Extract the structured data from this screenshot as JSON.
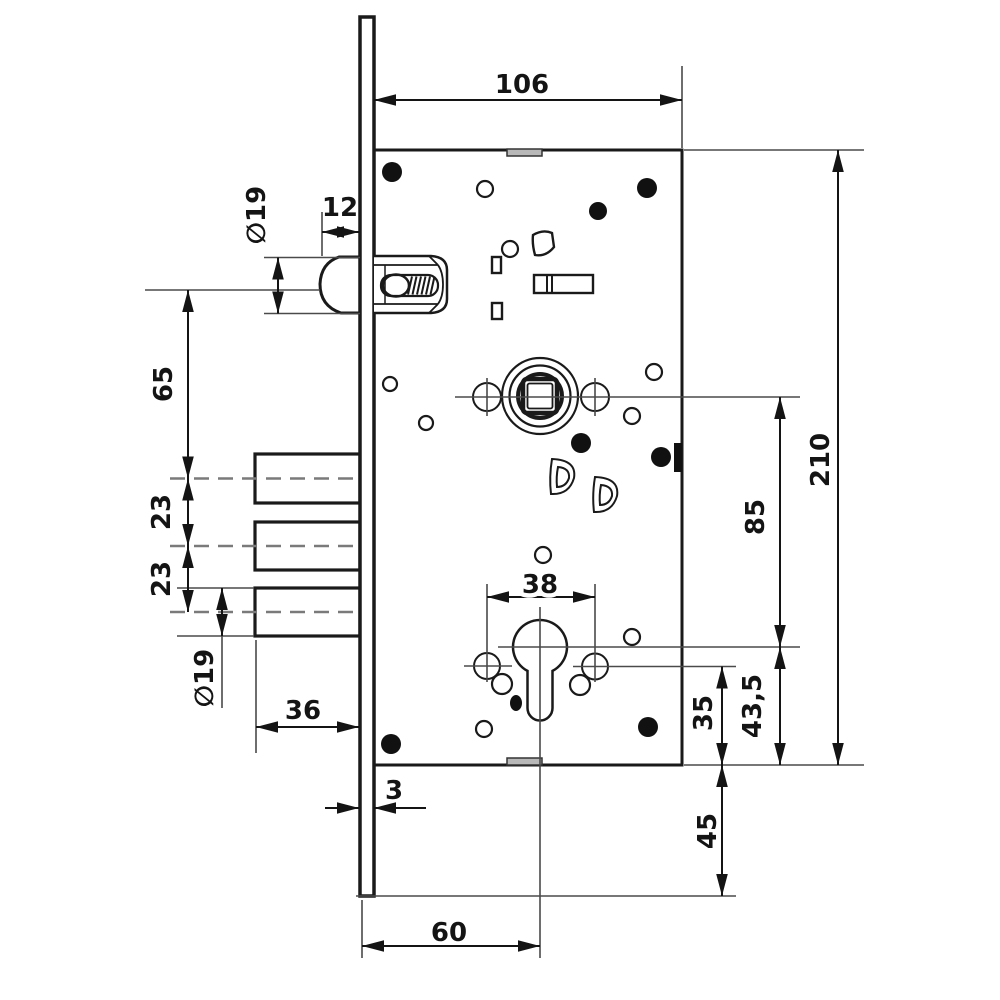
{
  "drawing": {
    "type": "mortise-lock-dimension-drawing",
    "colors": {
      "stroke": "#1a1a1a",
      "centerline": "#4a4a4a",
      "dashed_centerline": "#7a7a7a",
      "filled_holes": "#111111",
      "background": "#ffffff",
      "tab_fill": "#b8b8b8"
    },
    "labels": {
      "case_width": "106",
      "latch_protrusion": "12",
      "latch_diameter": "∅19",
      "latch_to_first_bolt": "65",
      "bolt_spacing_upper": "23",
      "bolt_spacing_lower": "23",
      "bolt_diameter": "∅19",
      "bolt_throw": "36",
      "faceplate_thickness": "3",
      "backset": "60",
      "case_height": "210",
      "spindle_to_cylinder": "85",
      "cylinder_to_case_bottom": "43,5",
      "fixing_hole_to_case_bottom": "35",
      "faceplate_extension_below_case": "45",
      "cylinder_fixing_span": "38"
    }
  }
}
